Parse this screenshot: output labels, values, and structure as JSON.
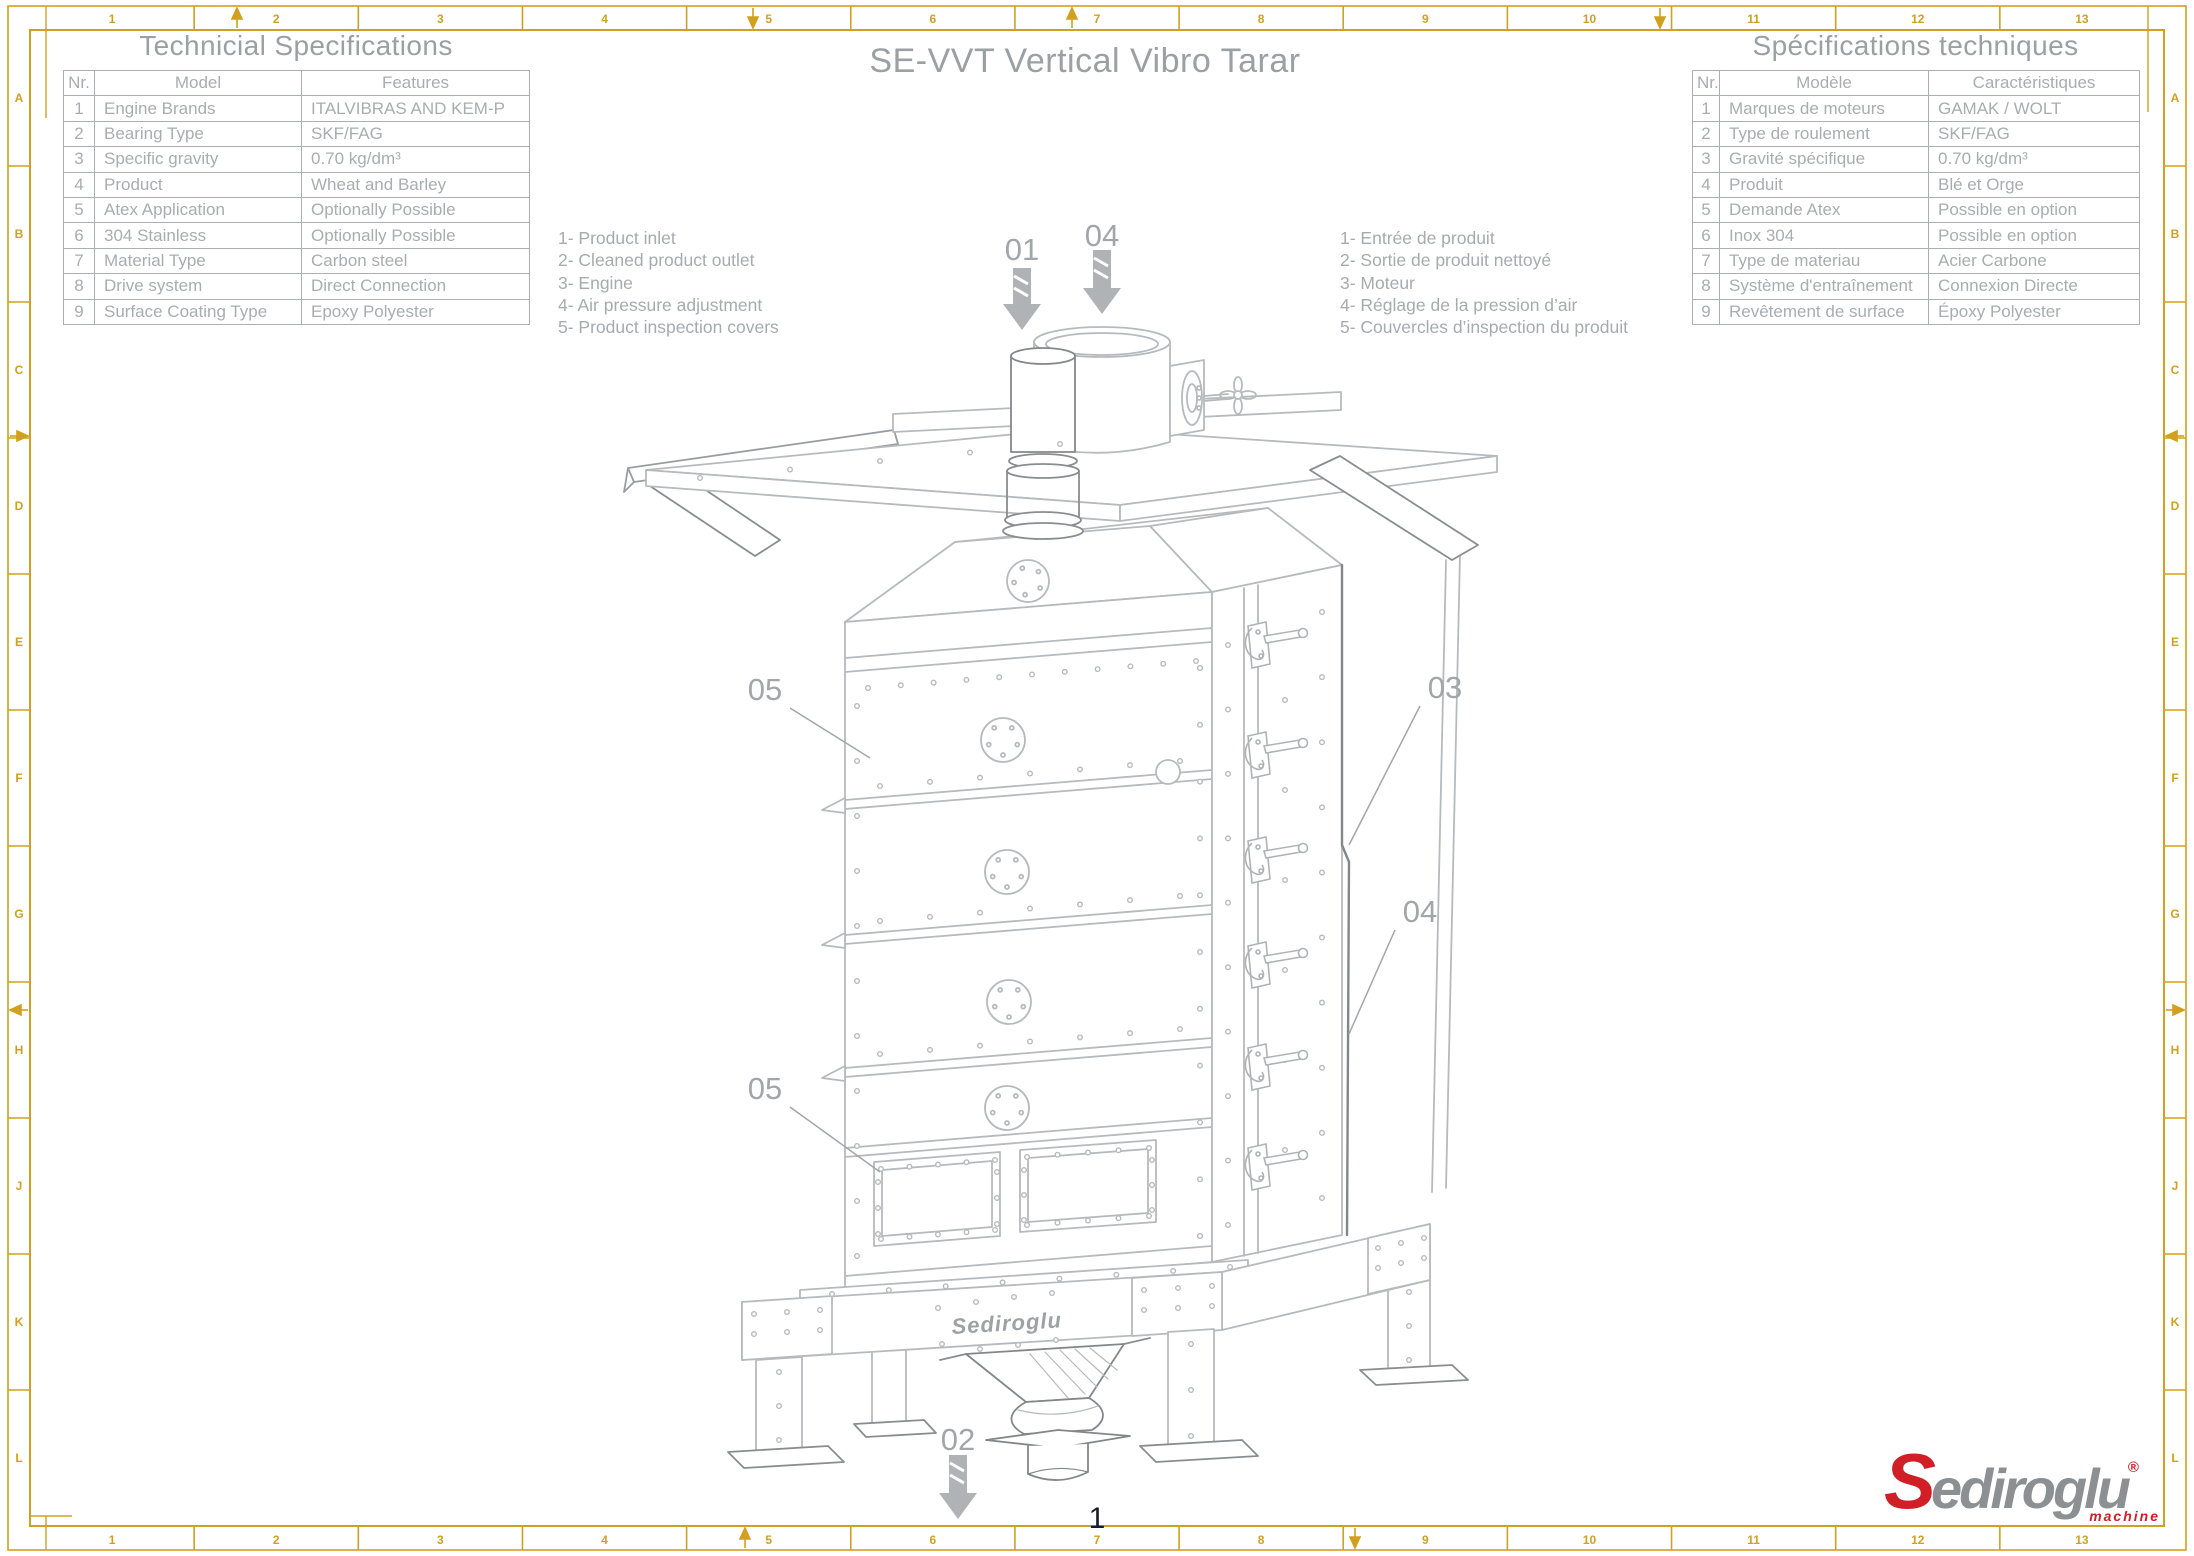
{
  "sheet": {
    "title": "SE-VVT Vertical Vibro Tarar",
    "page_number": "1"
  },
  "tables": {
    "en": {
      "title": "Technicial Specifications",
      "headers": [
        "Nr.",
        "Model",
        "Features"
      ],
      "rows": [
        [
          "1",
          "Engine Brands",
          "ITALVIBRAS AND KEM-P"
        ],
        [
          "2",
          "Bearing Type",
          "SKF/FAG"
        ],
        [
          "3",
          "Specific gravity",
          "0.70 kg/dm³"
        ],
        [
          "4",
          "Product",
          "Wheat and Barley"
        ],
        [
          "5",
          "Atex Application",
          "Optionally Possible"
        ],
        [
          "6",
          "304 Stainless",
          "Optionally Possible"
        ],
        [
          "7",
          "Material Type",
          "Carbon steel"
        ],
        [
          "8",
          "Drive system",
          "Direct Connection"
        ],
        [
          "9",
          "Surface Coating Type",
          "Epoxy Polyester"
        ]
      ]
    },
    "fr": {
      "title": "Spécifications techniques",
      "headers": [
        "Nr.",
        "Modèle",
        "Caractéristiques"
      ],
      "rows": [
        [
          "1",
          "Marques de moteurs",
          "GAMAK / WOLT"
        ],
        [
          "2",
          "Type de roulement",
          "SKF/FAG"
        ],
        [
          "3",
          "Gravité spécifique",
          "0.70 kg/dm³"
        ],
        [
          "4",
          "Produit",
          "Blé et Orge"
        ],
        [
          "5",
          "Demande Atex",
          "Possible en option"
        ],
        [
          "6",
          "Inox 304",
          "Possible en option"
        ],
        [
          "7",
          "Type de materiau",
          "Acier Carbone"
        ],
        [
          "8",
          "Système d'entraînement",
          "Connexion Directe"
        ],
        [
          "9",
          "Revêtement de surface",
          "Époxy Polyester"
        ]
      ]
    }
  },
  "legends": {
    "en": [
      "1- Product inlet",
      "2- Cleaned product outlet",
      "3- Engine",
      "4- Air pressure adjustment",
      "5- Product inspection covers"
    ],
    "fr": [
      "1- Entrée de produit",
      "2- Sortie de produit nettoyé",
      "3- Moteur",
      "4- Réglage de la pression d’air",
      "5- Couvercles d’inspection du produit"
    ]
  },
  "callouts": {
    "product_inlet": "01",
    "cleaned_product_outlet": "02",
    "engine": "03",
    "air_pressure_top": "04",
    "air_pressure_side": "04",
    "inspection_covers_upper": "05",
    "inspection_covers_lower": "05"
  },
  "machine": {
    "embossed_brand": "Sediroglu"
  },
  "logo": {
    "brand_initial": "S",
    "brand_rest": "ediroglu",
    "registered": "®",
    "sub": "machine"
  },
  "frame": {
    "columns": [
      "1",
      "2",
      "3",
      "4",
      "5",
      "6",
      "7",
      "8",
      "9",
      "10",
      "11",
      "12",
      "13"
    ],
    "rows": [
      "A",
      "B",
      "C",
      "D",
      "E",
      "F",
      "G",
      "H",
      "J",
      "K",
      "L"
    ]
  },
  "colors": {
    "frame_gold": "#D2A01E",
    "drawing_light": "#b7babd",
    "drawing_dark": "#84878a",
    "text_gray": "#a7abae",
    "logo_red": "#d01f27",
    "logo_gray": "#8d9093"
  }
}
